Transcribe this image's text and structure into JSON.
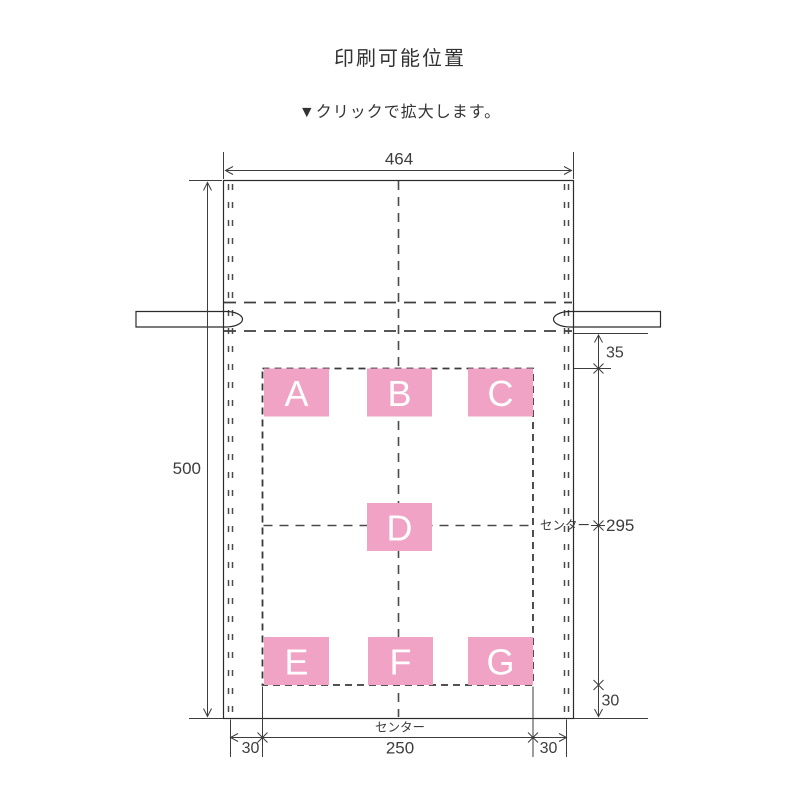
{
  "title": "印刷可能位置",
  "zoom_hint": "▼クリックで拡大します。",
  "diagram": {
    "dimensions": {
      "bag_width": "464",
      "bag_height": "500",
      "print_top_offset": "35",
      "print_height": "295",
      "print_bottom_offset": "30",
      "print_left_offset": "30",
      "print_width": "250",
      "print_right_offset": "30"
    },
    "center_label_side": "センター",
    "center_label_bottom": "センター",
    "zones": {
      "a": "A",
      "b": "B",
      "c": "C",
      "d": "D",
      "e": "E",
      "f": "F",
      "g": "G"
    },
    "colors": {
      "bag_fill": "#e6e6e6",
      "print_zone_pink": "#f0a3c5",
      "line": "#3d3d3d"
    }
  }
}
